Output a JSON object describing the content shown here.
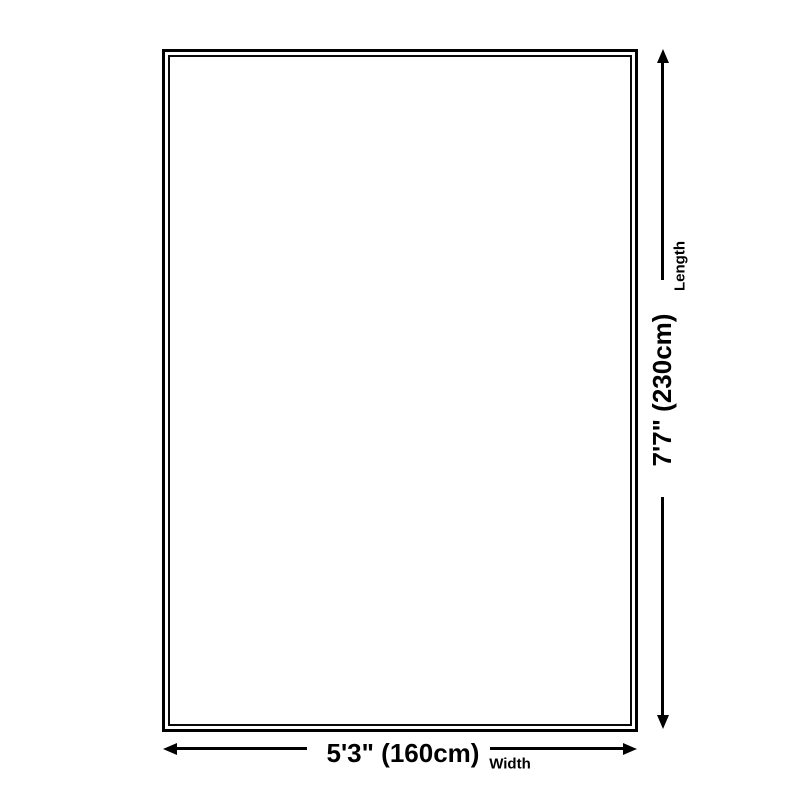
{
  "canvas": {
    "width": 800,
    "height": 800,
    "background_color": "#ffffff",
    "ink_color": "#000000"
  },
  "diagram": {
    "type": "product-dimension-diagram",
    "shape": "rectangle",
    "vertical": {
      "label": "Length",
      "value": "7'7\" (230cm)",
      "arrow_start_icon": "arrow-up",
      "arrow_end_icon": "arrow-down"
    },
    "horizontal": {
      "label": "Width",
      "value": "5'3\" (160cm)",
      "arrow_start_icon": "arrow-left",
      "arrow_end_icon": "arrow-right"
    }
  }
}
